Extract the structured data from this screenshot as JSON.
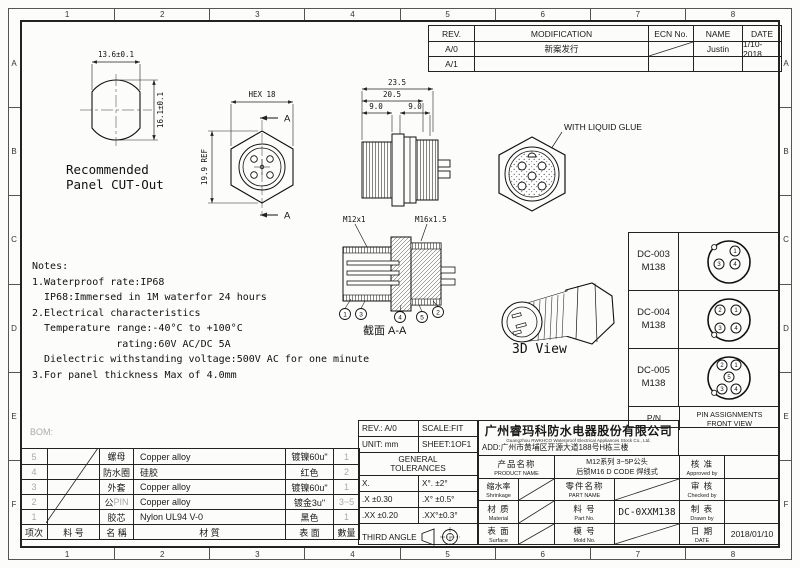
{
  "frame": {
    "cols": [
      "1",
      "2",
      "3",
      "4",
      "5",
      "6",
      "7",
      "8"
    ],
    "rows": [
      "A",
      "B",
      "C",
      "D",
      "E",
      "F"
    ]
  },
  "rev_table": {
    "headers": {
      "rev": "REV.",
      "modification": "MODIFICATION",
      "ecn": "ECN No.",
      "name": "NAME",
      "date": "DATE"
    },
    "rows": [
      {
        "rev": "A/0",
        "modification": "新案发行",
        "name": "Justin",
        "date": "1/10-2018"
      },
      {
        "rev": "A/1",
        "modification": "",
        "name": "",
        "date": ""
      }
    ]
  },
  "views": {
    "panel_cutout": {
      "dim_width": "13.6±0.1",
      "dim_height": "16.1±0.1",
      "caption": "Recommended\nPanel CUT-Out"
    },
    "hex_front": {
      "dim_hex": "HEX 18",
      "dim_ref": "19.9 REF",
      "section_mark": "A"
    },
    "side_view": {
      "dim_total": "23.5",
      "dim_mid": "20.5",
      "dim_left": "9.0",
      "dim_right": "9.0"
    },
    "glue_view": {
      "label": "WITH LIQUID GLUE"
    },
    "section_view": {
      "thread_left": "M12x1",
      "thread_right": "M16x1.5",
      "caption": "截面  A-A",
      "balloons": [
        "1",
        "3",
        "4",
        "5",
        "2"
      ]
    },
    "three_d_view": {
      "caption": "3D View"
    }
  },
  "notes": {
    "text": "Notes:\n1.Waterproof rate:IP68\n  IP68:Immersed in 1M waterfor 24 hours\n2.Electrical characteristics\n  Temperature range:-40°C to +100°C\n              rating:60V AC/DC 5A\n  Dielectric withstanding voltage:500V AC for one minute\n3.For panel thickness Max of 4.0mm"
  },
  "pin_table": {
    "rows": [
      {
        "pn": "DC-003",
        "model": "M138",
        "pins": [
          "1",
          "3",
          "4"
        ]
      },
      {
        "pn": "DC-004",
        "model": "M138",
        "pins": [
          "2",
          "1",
          "3",
          "4"
        ]
      },
      {
        "pn": "DC-005",
        "model": "M138",
        "pins": [
          "2",
          "1",
          "5",
          "3",
          "4"
        ]
      }
    ],
    "footer_label": "P/N",
    "footer_title": "PIN ASSIGNMENTS\nFRONT VIEW"
  },
  "bom": {
    "label": "BOM:",
    "headers": [
      "项次",
      "料 号",
      "名 稱",
      "材 質",
      "表 面",
      "數量"
    ],
    "rows": [
      {
        "idx": "5",
        "name": "螺母",
        "name_grey": "",
        "material": "Copper alloy",
        "surface": "镀镍60u\"",
        "qty": "1"
      },
      {
        "idx": "4",
        "name": "防水圈",
        "name_grey": "",
        "material": "硅胶",
        "surface": "红色",
        "qty": "2"
      },
      {
        "idx": "3",
        "name": "外套",
        "name_grey": "",
        "material": "Copper alloy",
        "surface": "镀镍60u\"",
        "qty": "1"
      },
      {
        "idx": "2",
        "name": "公",
        "name_grey": "PIN",
        "material": "Copper alloy",
        "surface": "镀金3u\"",
        "qty": "3~5"
      },
      {
        "idx": "1",
        "name": "胶芯",
        "name_grey": "",
        "material": "Nylon UL94 V-0",
        "surface": "黑色",
        "qty": "1"
      }
    ]
  },
  "title_block": {
    "rev": "REV.: A/0",
    "scale": "SCALE:FIT",
    "unit": "UNIT: mm",
    "sheet": "SHEET:1OF1",
    "general_tolerances": "GENERAL\nTOLERANCES",
    "tolerances": [
      [
        "X.",
        "X°. ±2°"
      ],
      [
        ".X ±0.30",
        ".X° ±0.5°"
      ],
      [
        ".XX ±0.20",
        ".XX°±0.3°"
      ]
    ],
    "third_angle": "THIRD ANGLE",
    "company": {
      "name": "广州睿玛科防水电器股份有限公司",
      "english": "Guangzhou RWKHCO Waterproof  Electrical Appliances Stock Co., Ltd.",
      "address": "ADD:广州市黄埔区开源大道188号H栋三楼"
    },
    "product_name_label": {
      "cn": "产品名称",
      "en": "PRODUCT NAME"
    },
    "product_name_value": "M12系列 3~5P公头\n后锁M16 D CODE 焊线式",
    "shrinkage": {
      "cn": "缩水率",
      "en": "Shrinkage"
    },
    "material": {
      "cn": "材 质",
      "en": "Material"
    },
    "surface": {
      "cn": "表 面",
      "en": "Surface"
    },
    "part_name": {
      "cn": "零件名称",
      "en": "PART NAME"
    },
    "part_no": {
      "cn": "料 号",
      "en": "Part No."
    },
    "part_no_value": "DC-0XXM138",
    "mold_no": {
      "cn": "模 号",
      "en": "Mold No."
    },
    "approved": {
      "cn": "核 准",
      "en": "Approved by"
    },
    "checked": {
      "cn": "审 核",
      "en": "Checked by"
    },
    "drawn": {
      "cn": "制 表",
      "en": "Drawn by"
    },
    "date": {
      "cn": "日 期",
      "en": "DATE"
    },
    "date_value": "2018/01/10"
  }
}
